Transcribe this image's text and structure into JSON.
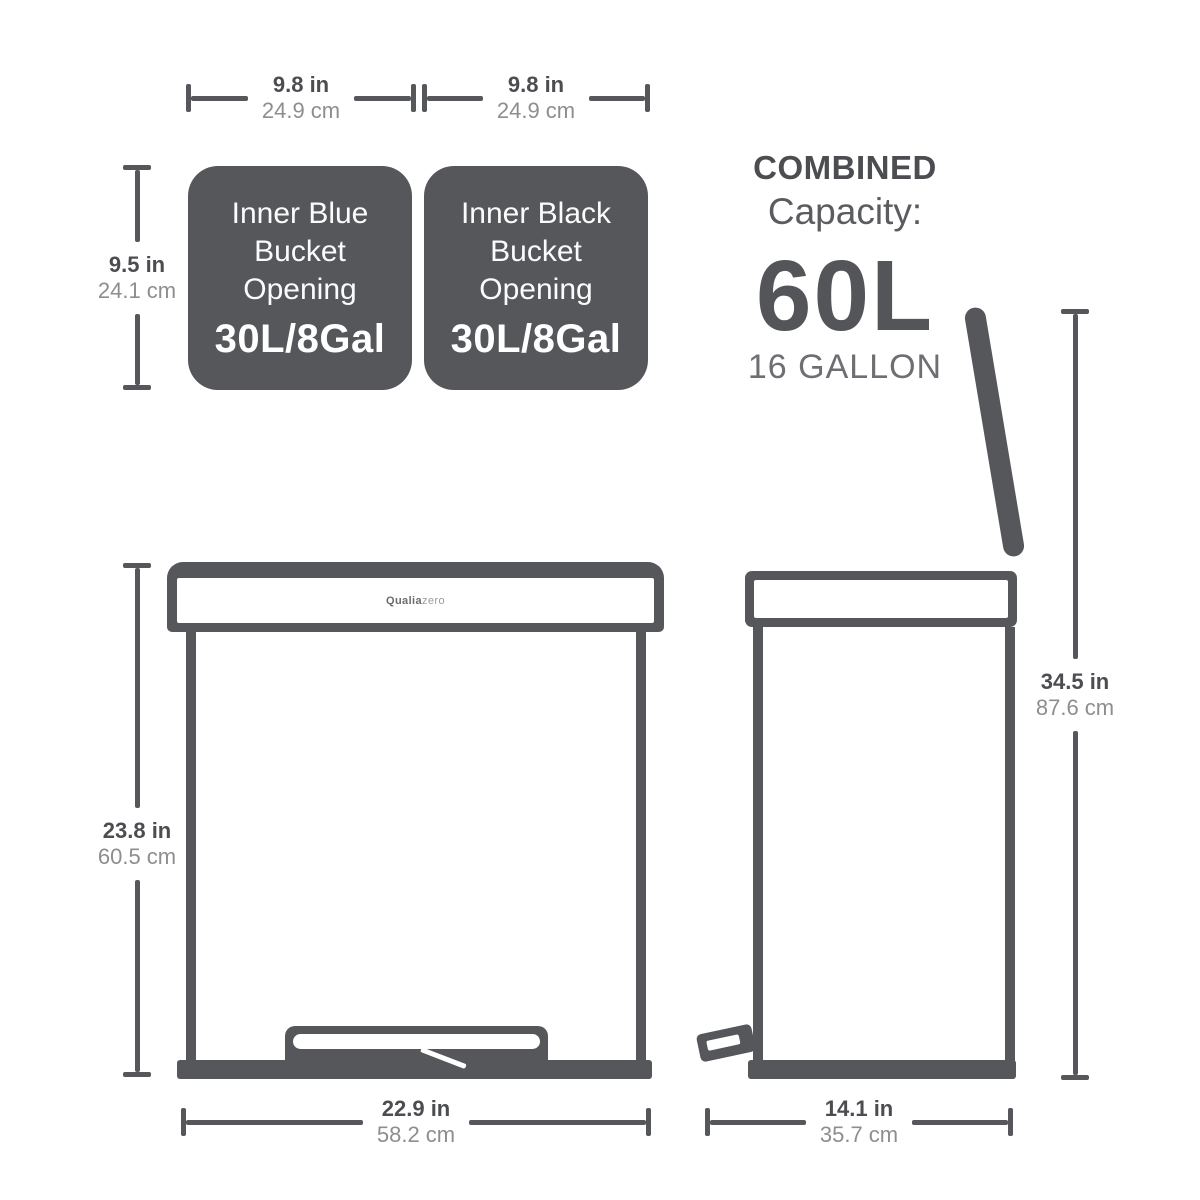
{
  "colors": {
    "shape": "#56575B",
    "label_dark": "#4C4D51",
    "label_muted": "#8D8E90",
    "white": "#FFFFFF"
  },
  "dims": {
    "bucket1_width": {
      "in": "9.8 in",
      "cm": "24.9 cm"
    },
    "bucket2_width": {
      "in": "9.8 in",
      "cm": "24.9 cm"
    },
    "bucket_height": {
      "in": "9.5 in",
      "cm": "24.1 cm"
    },
    "front_height": {
      "in": "23.8 in",
      "cm": "60.5 cm"
    },
    "front_width": {
      "in": "22.9 in",
      "cm": "58.2 cm"
    },
    "side_height": {
      "in": "34.5 in",
      "cm": "87.6 cm"
    },
    "side_depth": {
      "in": "14.1 in",
      "cm": "35.7 cm"
    }
  },
  "buckets": [
    {
      "line1": "Inner Blue",
      "line2": "Bucket",
      "line3": "Opening",
      "capacity": "30L/8Gal"
    },
    {
      "line1": "Inner Black",
      "line2": "Bucket",
      "line3": "Opening",
      "capacity": "30L/8Gal"
    }
  ],
  "combined": {
    "title": "COMBINED",
    "subtitle": "Capacity:",
    "liters": "60L",
    "gallons": "16 GALLON"
  },
  "brand": {
    "bold": "Qualia",
    "light": "zero"
  }
}
